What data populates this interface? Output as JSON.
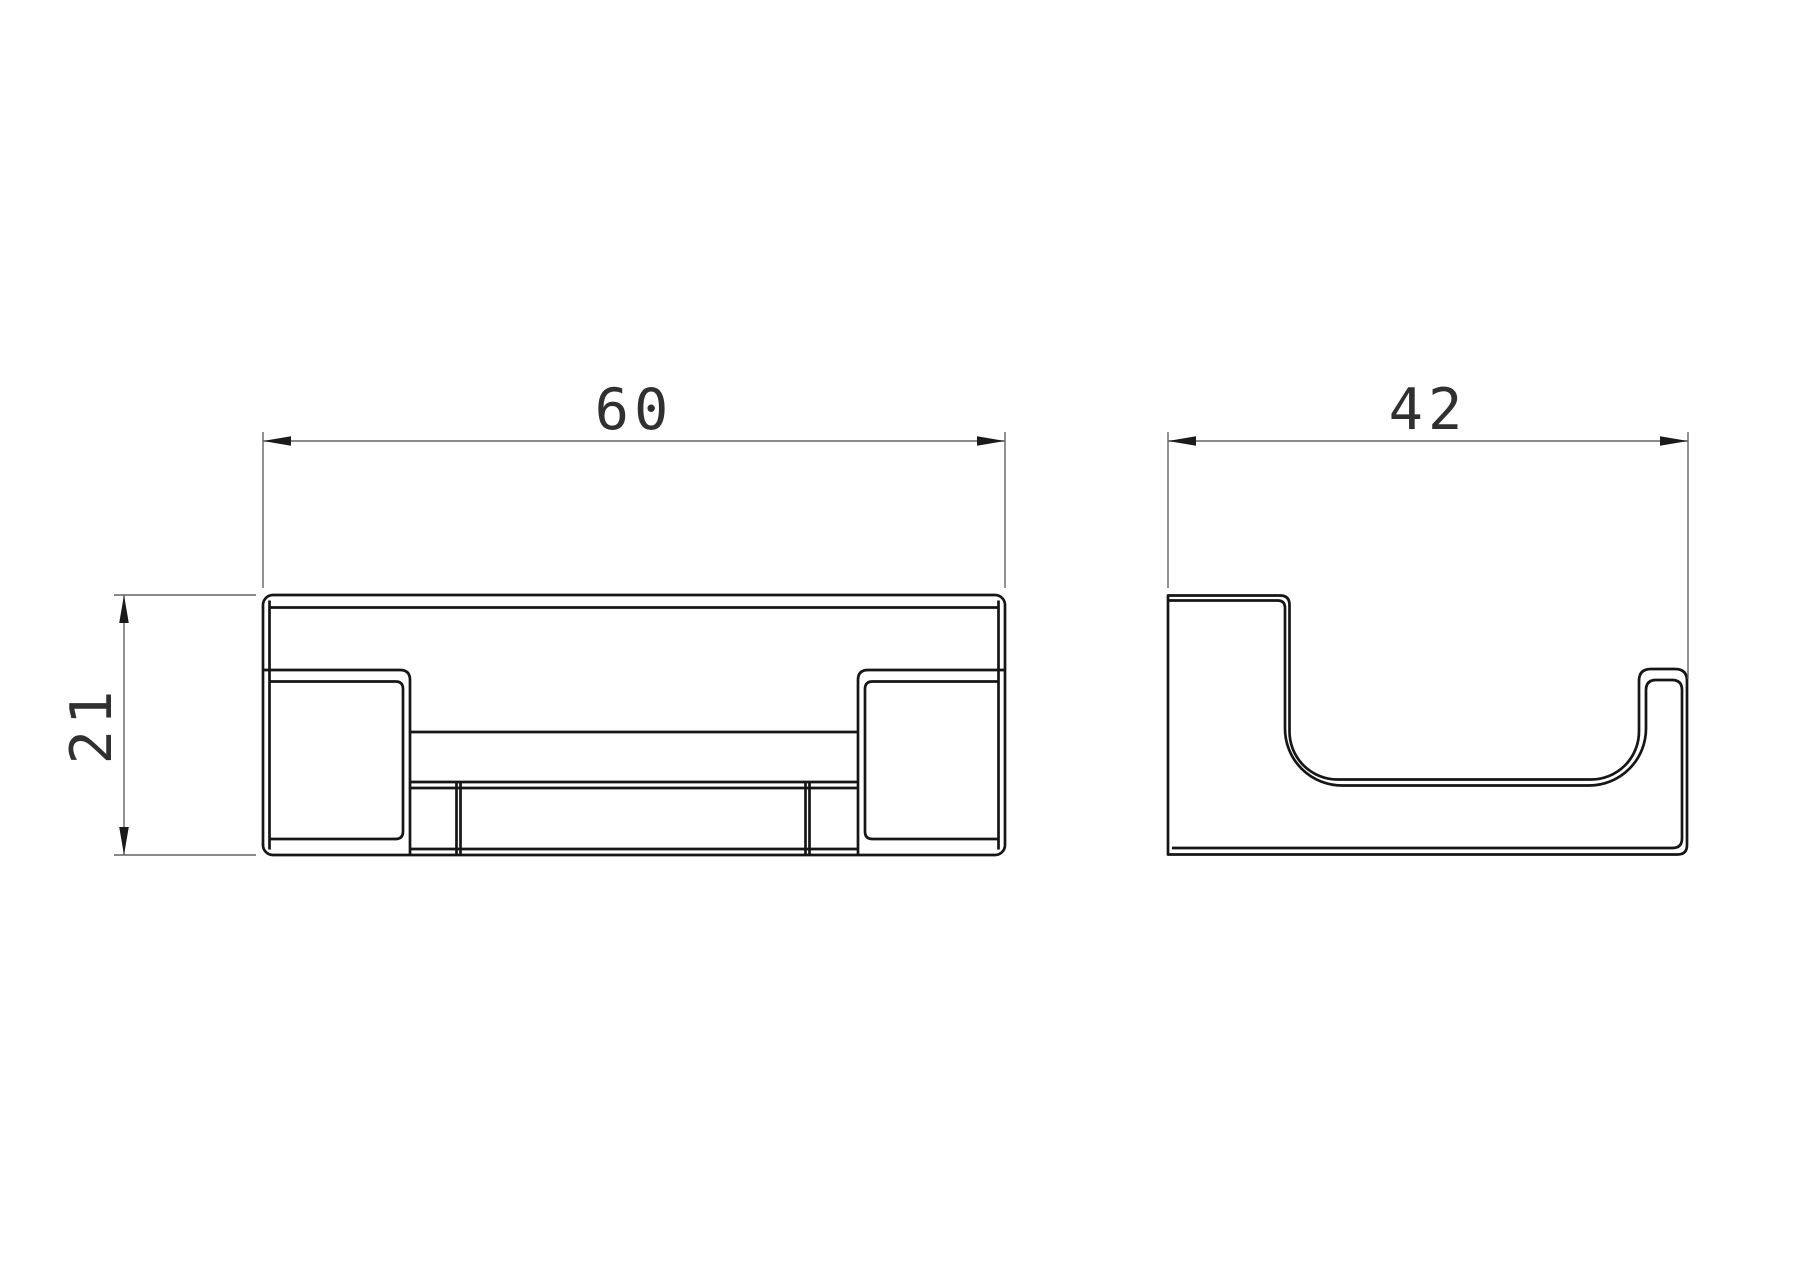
{
  "drawing": {
    "type": "orthographic technical drawing, two views of a wall hook",
    "units_per_px": 0.0809,
    "dimensions": {
      "width": {
        "value": "60",
        "axis": "horizontal",
        "view": "front"
      },
      "height": {
        "value": "21",
        "axis": "vertical",
        "view": "front"
      },
      "depth": {
        "value": "42",
        "axis": "horizontal",
        "view": "side"
      }
    },
    "views": {
      "front": {
        "name": "front-view",
        "left": 263,
        "top": 595,
        "width_px": 742,
        "height_px": 260
      },
      "side": {
        "name": "side-view",
        "left": 1168,
        "top": 595,
        "width_px": 520,
        "height_px": 260
      }
    }
  },
  "colors": {
    "background": "#ffffff",
    "part_line": "#161616",
    "dim_line": "#646464",
    "arrow": "#1a1a1a",
    "text": "#303030"
  }
}
